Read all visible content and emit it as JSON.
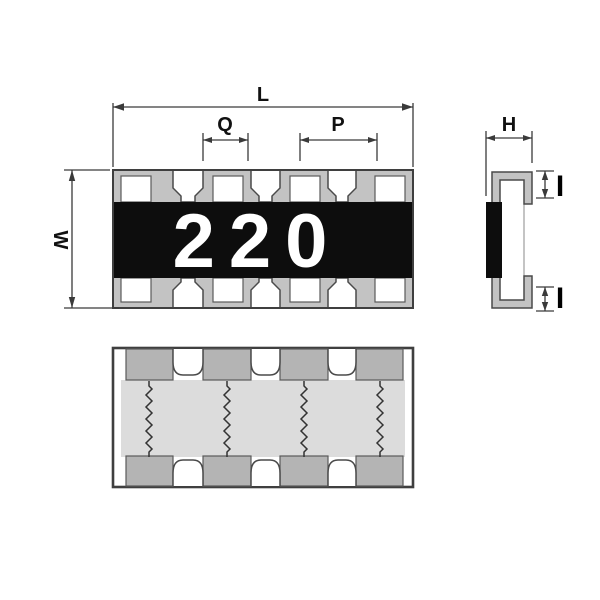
{
  "top_view": {
    "marking": "220",
    "dim_length": "L",
    "dim_inner": "Q",
    "dim_pitch": "P",
    "dim_width": "W"
  },
  "side_view": {
    "dim_height": "H",
    "dim_terminal_top": "I",
    "dim_terminal_bottom": "I"
  },
  "colors": {
    "pad_gray": "#c3c3c3",
    "pad_gray_dark": "#b4b4b4",
    "substrate_light": "#dcdcdc",
    "body_black": "#0d0d0d",
    "line_dark": "#3a3a3a",
    "marking_white": "#ffffff"
  }
}
